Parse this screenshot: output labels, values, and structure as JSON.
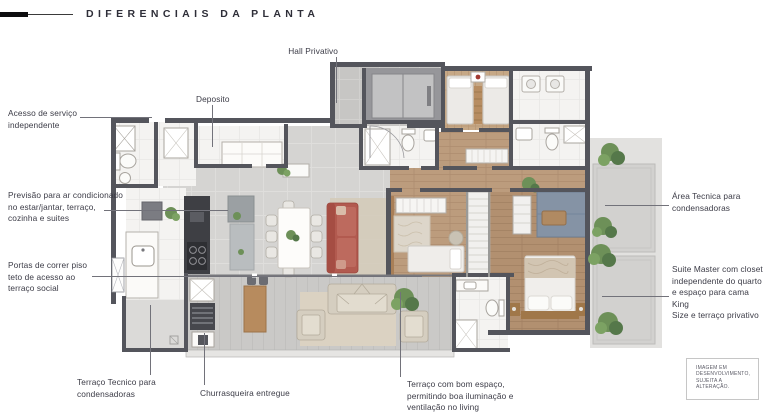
{
  "title": "DIFERENCIAIS DA PLANTA",
  "labels": {
    "hall_privativo": "Hall Privativo",
    "deposito": "Deposito",
    "acesso_servico": "Acesso de serviço\nindependente",
    "previsao_ar": "Previsão para ar condicionado\nno estar/jantar, terraço,\ncozinha e suites",
    "portas_correr": "Portas de correr piso\nteto de acesso ao\nterraço social",
    "terraco_tecnico": "Terraço Tecnico para\ncondensadoras",
    "churrasqueira": "Churrasqueira entregue",
    "terraco_living": "Terraço com bom espaço,\npermitindo boa iluminação e\nventilação no living",
    "area_tecnica": "Área Tecnica para\ncondensadoras",
    "suite_master": "Suite Master com closet\nindependente do quarto\ne espaço para cama King\nSize e terraço privativo"
  },
  "disclaimer": "IMAGEM EM\nDESENVOLVIMENTO,\nSUJEITA A ALTERAÇÃO.",
  "palette": {
    "wall": "#54555c",
    "tile_floor": "#d5d4d2",
    "hall_tile": "#c7c6c4",
    "wood_floor": "#bc9c7d",
    "white_floor": "#f4f3f1",
    "terrace_deck": "#cac9c7",
    "sofa_red": "#b25a4f",
    "closet_blue": "#8593a5",
    "plant_green": "#6d9058",
    "label_text": "#3b3b46"
  }
}
